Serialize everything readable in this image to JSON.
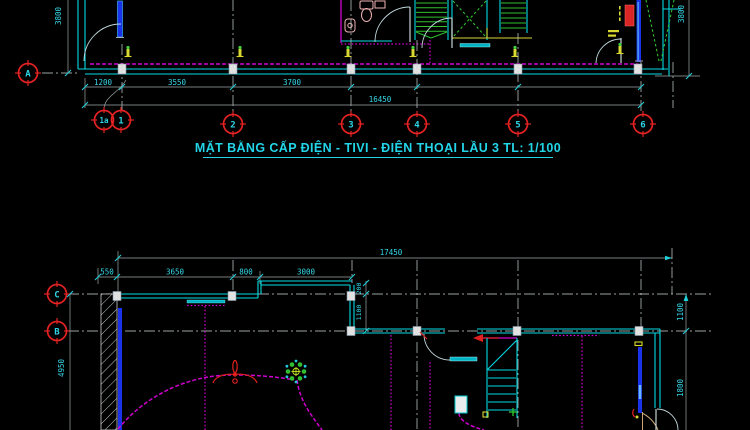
{
  "title": "MẶT BẰNG CẤP ĐIỆN - TIVI - ĐIỆN THOẠI LẦU 3 TL: 1/100",
  "colors": {
    "background": "#000000",
    "wall_cyan": "#00DCE6",
    "wiring_magenta": "#CF00CF",
    "grid_bubble_red": "#E32222",
    "text_cyan": "#35D8E8",
    "dim_line_gray": "#9FA8A8",
    "stair_green": "#2FBF2F",
    "fixture_yellow": "#D8D830",
    "door_blue": "#1A33EA",
    "panel_red": "#D82525",
    "title_cyan": "#23D5E8"
  },
  "upper_plan": {
    "grids_columns": [
      "1a",
      "1",
      "2",
      "3",
      "4",
      "5",
      "6"
    ],
    "grid_rows": [
      "A"
    ],
    "bay_dims": [
      "1200",
      "3550",
      "3700"
    ],
    "total_dim": "16450",
    "left_dim": "3800",
    "right_dim": "3800"
  },
  "lower_plan": {
    "grid_rows": [
      "C",
      "B"
    ],
    "bay_dims": [
      "550",
      "3650",
      "800",
      "3000"
    ],
    "total_dim": "17450",
    "left_dim": "4950",
    "right_dims": [
      "1100",
      "1800"
    ],
    "step_dims": [
      "200",
      "1100"
    ]
  }
}
